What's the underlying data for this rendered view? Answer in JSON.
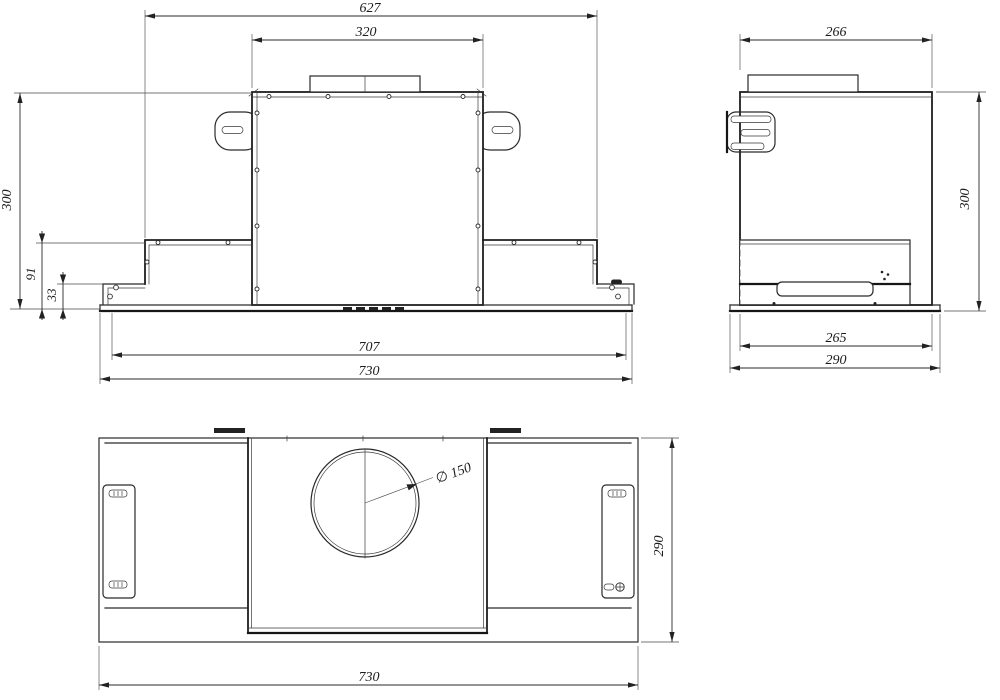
{
  "drawing": {
    "background": "#ffffff",
    "line_color": "#2a2a2a",
    "views": {
      "front": {
        "label": "front view",
        "dims": {
          "overall_top": "627",
          "duct_width": "320",
          "height": "300",
          "lower_height": "91",
          "visor_height": "33",
          "body_width": "707",
          "overall_width": "730"
        }
      },
      "side": {
        "label": "side view",
        "dims": {
          "top_depth": "266",
          "height": "300",
          "body_depth": "265",
          "overall_depth": "290"
        }
      },
      "plan": {
        "label": "bottom view",
        "dims": {
          "duct_diameter": "∅ 150",
          "depth": "290",
          "overall_width": "730"
        }
      }
    }
  }
}
